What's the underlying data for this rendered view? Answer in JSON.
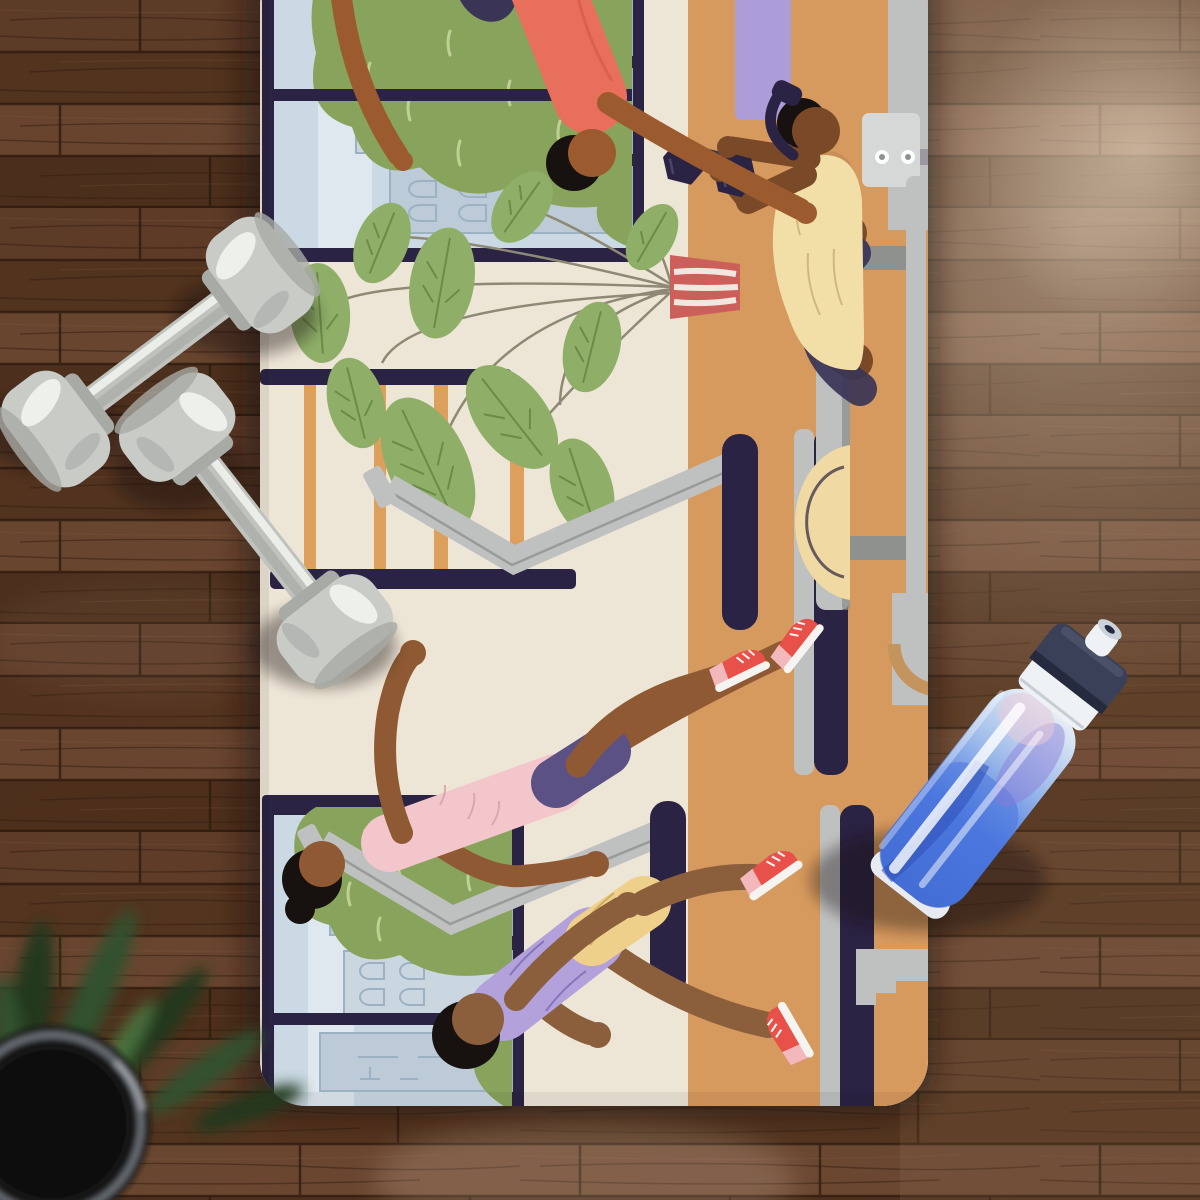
{
  "scene": {
    "type": "product-photo",
    "subject": "Rubber yoga mat printed with a sideways flat-style gym illustration, lying on dark hardwood floor with two gray dumbbells, a sport water bottle and a blurred houseplant",
    "camera": "top-down",
    "canvas": {
      "width": 1200,
      "height": 1200
    }
  },
  "floor": {
    "material": "dark stained hardwood planks, horizontal",
    "lighting": [
      "bright window glare at upper right",
      "soft sheen reflection near mat bottom corner"
    ]
  },
  "mat": {
    "shape": "portrait rounded-rectangle, top edge cropped by frame",
    "artwork_orientation": "illustration rotated 90 degrees (scene top faces image left)",
    "artwork": {
      "setting": "gym interior with large city-view windows, cream walls and tan floor",
      "windows": [
        {
          "position": "left",
          "contents": [
            "sky band",
            "outlined city buildings with arched windows",
            "tall green tree canopy",
            "small bush"
          ]
        },
        {
          "position": "right",
          "contents": [
            "sky band",
            "outlined city buildings",
            "tall green tree canopy",
            "raised arm of off-canvas person"
          ]
        }
      ],
      "wall_features": [
        "dark navy rails with orange rungs (wall trellis)",
        "tall potted plant with red striped pot"
      ],
      "equipment": [
        "two treadmills with gray masts and navy hoods/decks",
        "gray flat bench with metal base",
        "navy hex dumbbell",
        "pale yellow half-dome bag",
        "lavender platform",
        "gray machine bases and steps"
      ],
      "figures": [
        {
          "name": "runner-woman",
          "clothing": "pink top, purple shorts, red sneakers, hair bun",
          "activity": "running on treadmill"
        },
        {
          "name": "runner-man",
          "clothing": "lilac t-shirt, yellow shorts, red sneakers",
          "activity": "running on treadmill"
        },
        {
          "name": "bench-press-man",
          "clothing": "pale yellow tee, tan shorts, navy leggings, navy headphones",
          "activity": "pressing a navy hex dumbbell while lying on bench"
        },
        {
          "name": "spotter",
          "clothing": "coral shirt",
          "activity": "leaning over the bench reaching toward the dumbbell"
        }
      ]
    }
  },
  "objects": {
    "dumbbells": {
      "count": 2,
      "material": "gray vinyl-coated",
      "arrangement": "two crossed diagonals at upper left, lower head of second resting on the mat"
    },
    "water_bottle": {
      "style": "sport squeeze bottle",
      "cap": "navy push-pull cap with white spout and collar",
      "contents": "blue water with purple-pink marbling",
      "tilt": "leaning, top toward upper right",
      "position": "straddling right edge of mat"
    },
    "houseplant": {
      "pot": "dark round planter with thin metallic rim",
      "foliage": "blurred dark-green blades",
      "position": "bottom-left corner, out of focus"
    }
  },
  "colors": {
    "wood_base_1": "#543520",
    "wood_base_2": "#6A472F",
    "plank_a": "#5E3C28",
    "plank_b": "#52331E",
    "plank_c": "#6B4731",
    "plank_d": "#4B2E1B",
    "plank_seam": "#231307",
    "wood_grain": "#2E1A0D",
    "glare": "#FFEFD8",
    "mat_cream": "#EDE5D6",
    "shadow": "#140C07",
    "ill_navy": "#2B2343",
    "gym_floor": "#D79A5E",
    "rung_orange": "#DD9F5C",
    "sky": "#CBD9E4",
    "sky_band": "#DFE8EE",
    "building": "#BCCBD7",
    "building_light": "#CBD7E0",
    "building_line": "#9CB2C3",
    "bush": "#88A35C",
    "bush_dash": "#BCD192",
    "leaf": "#8FAE68",
    "leaf_vein": "#6B8C49",
    "stem": "#8D8974",
    "pot_red": "#CC5F5A",
    "pot_stripe": "#F3EFE6",
    "machine_gray": "#BFC1C0",
    "machine_gray_dark": "#8E918D",
    "machine_gray_light": "#D6D8D7",
    "skin_woman": "#8F5A33",
    "skin_runner": "#8B5E3C",
    "skin_bench": "#7A4A28",
    "skin_spotter": "#9C5B2E",
    "hair": "#17120F",
    "pink_top": "#F2C6CB",
    "pink_shade": "#D9A4AC",
    "purple_shorts": "#5C5184",
    "purple_tee": "#B2A1DA",
    "purple_tee_line": "#8070B8",
    "yellow_shorts": "#EFD08A",
    "yellow_shorts_line": "#C9A95C",
    "tee_yellow": "#F2DFA8",
    "tee_yellow_line": "#CBB478",
    "navy_wear": "#3A3456",
    "coral": "#E96F5D",
    "tan_shorts": "#C98F58",
    "lavender": "#AC9DD8",
    "bosu_yellow": "#F0D9A2",
    "shoe_red": "#E8504A",
    "shoe_pink": "#F3B8BC",
    "shoe_white": "#F6F4F0",
    "dumbbell_body": "#C9CBC7",
    "dumbbell_handle": "#BFC2BD",
    "dumbbell_dark": "#A7AAA5",
    "dumbbell_hi": "#F2F4F0",
    "cap_navy": "#3A4058",
    "cap_navy_dark": "#262A3E",
    "bottle_white": "#EFF2F5",
    "water_light": "#9FBCEA",
    "water_blue": "#4A77DE",
    "water_deep": "#3B63C8",
    "water_purple": "#8A7BD8",
    "plant_dark": "#22391F",
    "plant_mid": "#33512F",
    "plant_light": "#4E7A42",
    "planter_black": "#121214",
    "planter_rim": "#787E84"
  }
}
